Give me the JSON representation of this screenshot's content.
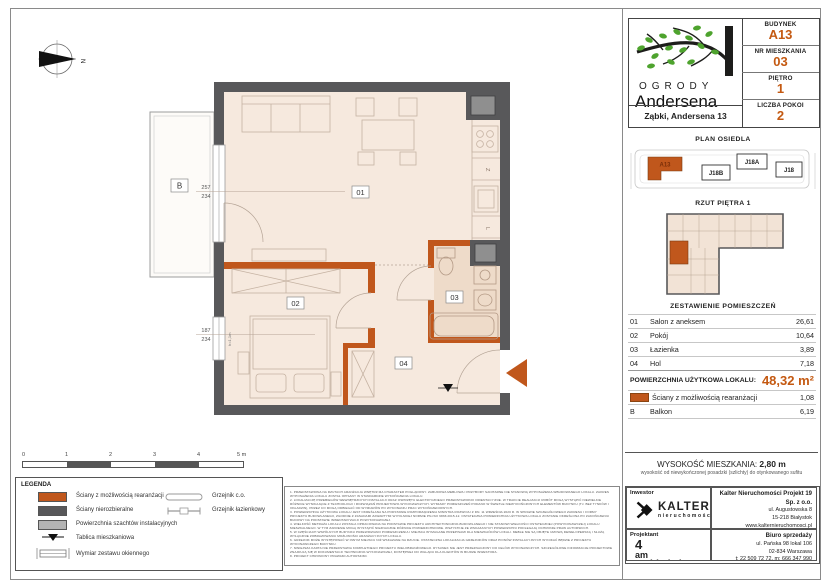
{
  "colors": {
    "accent_orange": "#c45911",
    "wall_dark": "#58585a",
    "wall_reconfigurable": "#c0571c",
    "shaft_gray": "#8f8f8f",
    "floor": "#f6e9de",
    "floor_bathroom": "#eedbc9"
  },
  "compass": {
    "north": "N"
  },
  "plan": {
    "rooms": [
      {
        "label": "01"
      },
      {
        "label": "02"
      },
      {
        "label": "03"
      },
      {
        "label": "04"
      }
    ],
    "balcony_label": "B",
    "dims": {
      "w1_top": "257",
      "w1_bottom": "234",
      "w2_top": "187",
      "w2_bottom": "234",
      "w2_side": "h=1,1m"
    },
    "kitchen": {
      "dishwasher": "Z",
      "fridge": "L"
    }
  },
  "sidebar": {
    "logo": {
      "line1": "OGRODY",
      "line2": "Andersena",
      "address": "Ząbki, Andersena 13"
    },
    "unit_info": [
      {
        "label": "BUDYNEK",
        "value": "A13"
      },
      {
        "label": "NR MIESZKANIA",
        "value": "03"
      },
      {
        "label": "PIĘTRO",
        "value": "1"
      },
      {
        "label": "LICZBA POKOI",
        "value": "2"
      }
    ],
    "site_plan": {
      "title": "PLAN OSIEDLA",
      "buildings": [
        "A13",
        "J18B",
        "J18A",
        "J18"
      ]
    },
    "floor_overview": {
      "title": "RZUT PIĘTRA 1"
    },
    "rooms_table": {
      "title": "ZESTAWIENIE POMIESZCZEŃ",
      "rows": [
        {
          "no": "01",
          "name": "Salon z aneksem",
          "area": "26,61"
        },
        {
          "no": "02",
          "name": "Pokój",
          "area": "10,64"
        },
        {
          "no": "03",
          "name": "Łazienka",
          "area": "3,89"
        },
        {
          "no": "04",
          "name": "Hol",
          "area": "7,18"
        }
      ],
      "total_label": "POWIERZCHNIA UŻYTKOWA LOKALU:",
      "total_value": "48,32 m²",
      "extra_rows": [
        {
          "no": "",
          "name": "Ściany z możliwością rearanżacji",
          "area": "1,08"
        },
        {
          "no": "B",
          "name": "Balkon",
          "area": "6,19"
        }
      ]
    },
    "height": {
      "label": "WYSOKOŚĆ MIESZKANIA:",
      "value": "2,80 m",
      "note": "wysokość od niewykończonej posadzki (szlichty) do otynkowanego sufitu"
    },
    "contacts": {
      "investor_label": "Inwestor",
      "investor_logo": {
        "name": "KALTER",
        "sub": "nieruchomości"
      },
      "designer_label": "Projektant",
      "designer_logo": {
        "l1": "4",
        "l2": "am",
        "l3": "architekci"
      },
      "company": {
        "name": "Kalter Nieruchomości Projekt 19 Sp. z o.o.",
        "line1": "ul. Augustowska 8",
        "line2": "15-218 Białystok",
        "line3": "www.kalternieruchomosci.pl"
      },
      "sales": {
        "name": "Biuro sprzedaży",
        "line1": "ul. Pańska 98 lokal 106",
        "line2": "02-834 Warszawa",
        "line3": "t: 22 509 72 72, m: 666 347 990",
        "line4": "email: andersena@kalternieruchomosci.pl"
      }
    }
  },
  "legend": {
    "title": "LEGENDA",
    "items_left": [
      "Ściany z możliwością rearanżacji",
      "Ściany nierozbieralne",
      "Powierzchnia szachtów instalacyjnych",
      "Tablica mieszkaniowa",
      "Wymiar zestawu okiennego"
    ],
    "items_right": [
      "Grzejnik c.o.",
      "Grzejnik łazienkowy"
    ]
  },
  "scalebar": {
    "labels": [
      "0",
      "1",
      "2",
      "3",
      "4",
      "5 m"
    ]
  },
  "disclaimer": {
    "items": [
      "1.  PRZEDSTAWIONA NA RZUTACH ARANŻACJA WNĘTRZ MA CHARAKTER POGLĄDOWY. ZABUDOWA MEBLOWA I PRZYBORY SANITARNE NIE STANOWIĄ WYPOSAŻENIA WBUDOWANEGO LOKALU. ZAKRES WYPOSAŻENIA LOKALU ZOSTAŁ OPISANY W STANDARDZIE WYKOŃCZENIA LOKALU.",
      "2.  LOKALIZACJĘ PRZEBIEGÓW WEWNĘTRZNYCH INSTALACJI ORAZ OSPRZĘTU ELEKTRYCZNEGO PRZEDSTAWIONO ORIENTACYJNIE. W TRAKCIE REALIZACJI ROBÓT MOGĄ WYSTĄPIĆ NIEWIELKIE RÓŻNICE WYNIKAJĄCE Z TECHNOLOGII I ROZWIĄZAŃ PROJEKTOWO-WYKONAWCZYCH. WYMIARY POMIESZCZEŃ PODANO W ŚWIETLE NIEWYKOŃCZONYCH ELEMENTÓW BUDYNKU (TJ. BEZ TYNKÓW I OKŁADZIN), PRZEZ CO MOGĄ ODBIEGAĆ OD WYMIARÓW PO WYKONANIU PRAC WYKOŃCZENIOWYCH.",
      "3.  POWIERZCHNIA UŻYTKOWA LOKALU JEST OKREŚLANA NA PODSTAWIE ROZPORZĄDZENIA MINISTRA ROZWOJU Z DN. 11 WRZEŚNIA 2020 R. W SPRAWIE SZCZEGÓŁOWEGO ZAKRESU I FORMY PROJEKTU BUDOWLANEGO, ZGODNIE Z ZASADAMI ZAWARTYMI W POLSKIEJ NORMIE PN-ISO 9836:2015-12. OSTATECZNA POWIERZCHNIA UŻYTKOWA LOKALU ZOSTANIE OKREŚLONA PO ZAKOŃCZENIU BUDOWY NA PODSTAWIE INWENTARYZACJI POWYKONAWCZEJ.",
      "4.  WIELKOŚĆ METRAŻA LOKALU ZOSTAŁA OPRACOWANA NA PODSTAWIE PROJEKTU ARCHITEKTONICZNO-BUDOWLANEGO I NIE STANOWI WIELKOŚCI OSTATECZNEJ (POWYKONAWCZEJ) LOKALU MIESZKALNEGO. W TYM ZAKRESIE MOGĄ WYSTĄPIĆ NIEZNACZNE RÓŻNICE POWIERZCHNIOWE. WSZYSTKIE ZE WSKAZANYCH POWIERZCHNI PODLEGAJĄ OCHRONIE PRAW AUTORSKICH.",
      "5.  W CZĘŚCIACH WSPÓLNYCH BUDYNKU PRZEWIDZIANO POMIESZCZENIA I MIEJSCA WYMAGANE PRZEPISAMI DLA MIESZKAŃCÓW LOKALI. MEBLE NIE SĄ OBJĘTE UMOWĄ DEWELOPERSKĄ I SŁUŻĄ WYŁĄCZNIE ZOBRAZOWANIU MOŻLIWOŚCI ARANŻACYJNYCH LOKALU.",
      "6.  GRZEJNIK MOŻE WYSTĘPOWAĆ W INNYM MIEJSCU NIŻ WSKAZANE NA RZUCIE. OSTATECZNA LOKALIZACJA GRZEJNIKÓW ORAZ PIONÓW INSTALACYJNYCH WYNIKAĆ BĘDZIE Z PROJEKTU WYKONAWCZEGO BUDYNKU.",
      "7.  NINIEJSZA KARTA NIE PRZEDSTAWIA KOMPLETNEGO PROJEKTU WIELOBRANŻOWEGO. RYSUNEK NIE JEST PRZEZNACZONY DO CELÓW WYKONAWCZYCH. SZCZEGÓŁOWE INFORMACJE PROJEKTOWE ZNAJDUJĄ SIĘ W DOKUMENTACJI TECHNICZNO-WYKONAWCZEJ, DOSTĘPNEJ DO WGLĄDU DLA KLIENTÓW W BIURZE INWESTORA.",
      "8.  PROJEKT CHRONIONY PRAWAMI AUTORSKIMI."
    ]
  }
}
